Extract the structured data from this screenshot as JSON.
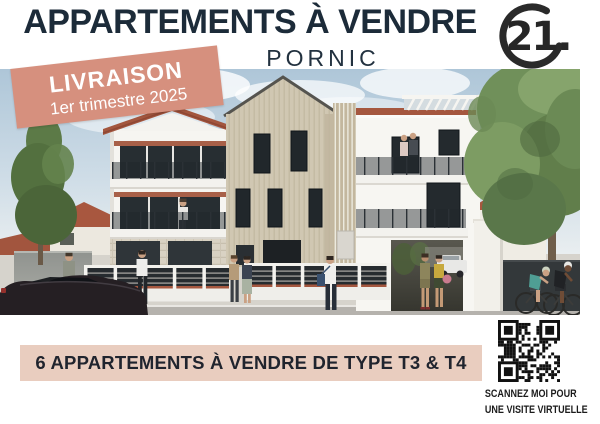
{
  "poster": {
    "header": {
      "title": "APPARTEMENTS À VENDRE",
      "city": "PORNIC"
    },
    "logo": {
      "number": "21."
    },
    "delivery_banner": {
      "line1": "LIVRAISON",
      "line2": "1er trimestre 2025"
    },
    "bottom_bar": {
      "text": "6 APPARTEMENTS À VENDRE DE TYPE T3 & T4"
    },
    "qr_block": {
      "caption_line1": "SCANNEZ MOI POUR",
      "caption_line2": "UNE VISITE VIRTUELLE"
    },
    "colors": {
      "accent_salmon": "#d6907e",
      "bar_peach": "#e9cdbf",
      "title_navy": "#1c2b39",
      "logo_dark": "#2a2a2a"
    }
  }
}
